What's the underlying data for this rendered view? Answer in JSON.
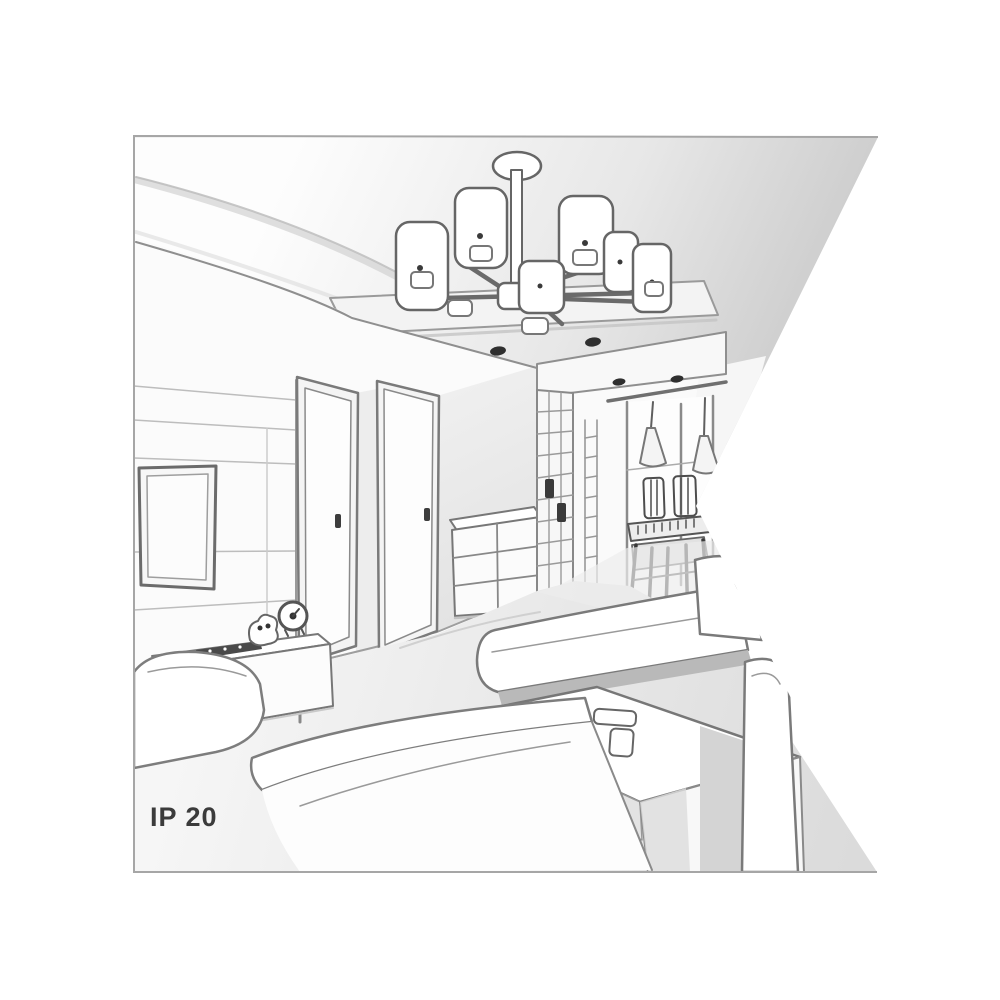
{
  "page": {
    "background_color": "#ffffff"
  },
  "sketch": {
    "label": "IP 20",
    "colors": {
      "border": "#a6a6a6",
      "outline": "#6e6e6e",
      "outline_dark": "#3c3c3c",
      "ceiling_shade": "#c9c9c9",
      "wall_shade": "#e9e9e9",
      "floor_shade": "#dcdcdc",
      "label_text": "#3b3b3b"
    },
    "elements": [
      "ceiling-cove",
      "dropped-ceiling-panel",
      "chandelier-6-shades",
      "recessed-spotlights",
      "wall-paneling",
      "flat-screen-tv",
      "tv-sideboard",
      "alarm-clock",
      "remote-control",
      "interior-door-left",
      "interior-door-right",
      "drawer-chest",
      "hallway-closet",
      "window-wall",
      "pendant-lamps",
      "dining-table",
      "dining-chairs",
      "corner-sofa",
      "coffee-table",
      "teapot-tray",
      "ip-rating-label"
    ]
  }
}
